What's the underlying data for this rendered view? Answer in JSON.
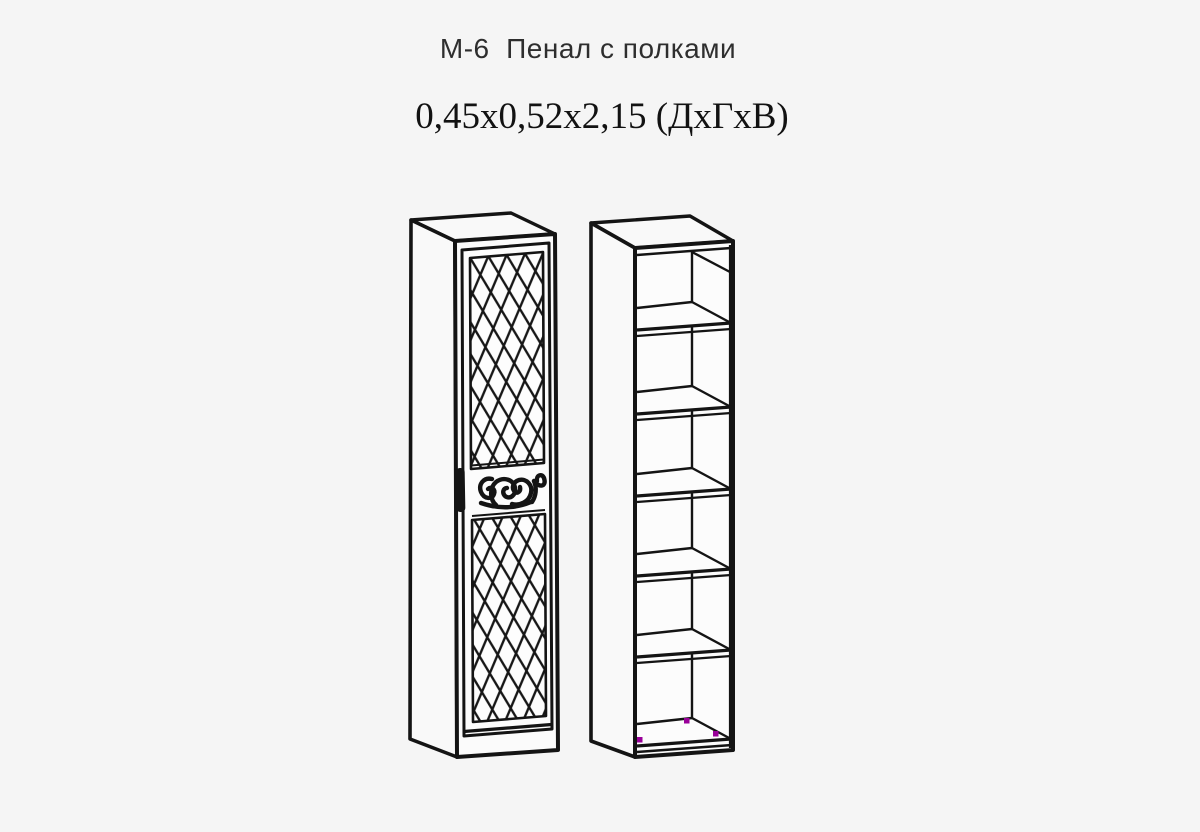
{
  "header": {
    "model_title": "М-6  Пенал с полками",
    "dimensions_line": "0,45x0,52x2,15 (ДхГхВ)"
  },
  "drawing": {
    "line_color": "#141414",
    "panel_fill": "#fbfbfb",
    "background_color": "#f5f5f5",
    "fitting_marker_color": "#990099",
    "shelf_compartments": "6"
  }
}
